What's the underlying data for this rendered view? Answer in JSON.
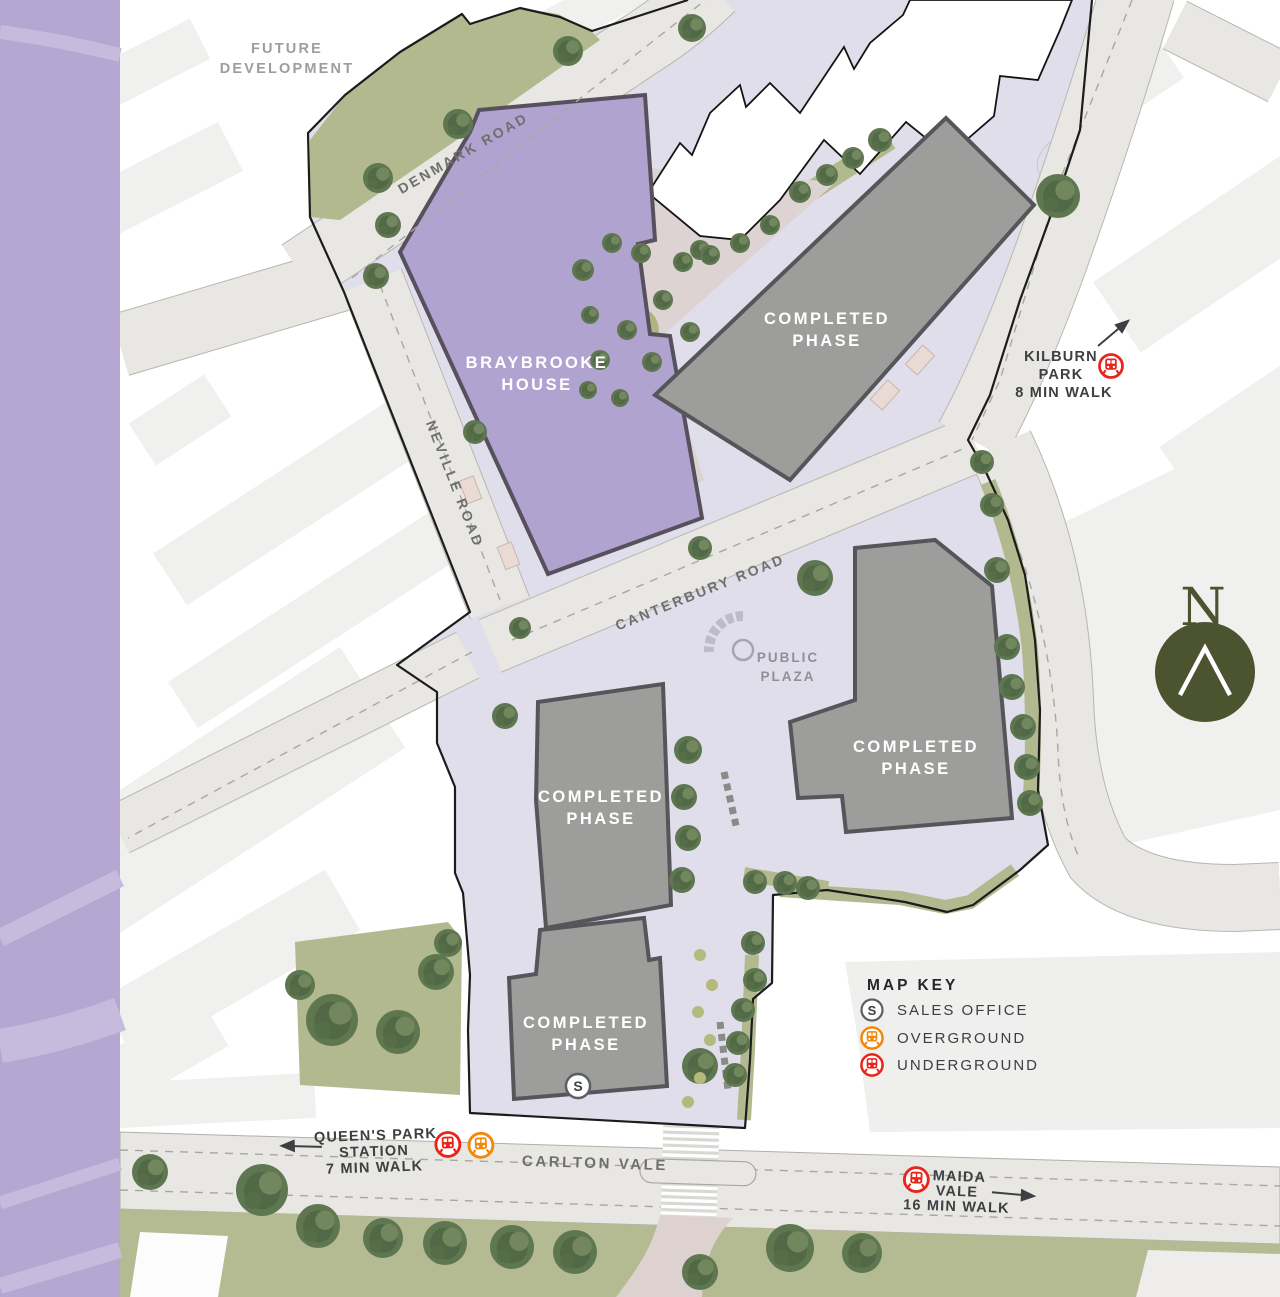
{
  "page": {
    "title": "Development Site Plan"
  },
  "areas": {
    "future_development": {
      "line1": "FUTURE",
      "line2": "DEVELOPMENT"
    },
    "braybrooke": {
      "line1": "BRAYBROOKE",
      "line2": "HOUSE"
    },
    "completed_phase": {
      "line1": "COMPLETED",
      "line2": "PHASE"
    },
    "public_plaza": {
      "line1": "PUBLIC",
      "line2": "PLAZA"
    }
  },
  "roads": {
    "denmark": "DENMARK ROAD",
    "neville": "NEVILLE ROAD",
    "canterbury": "CANTERBURY ROAD",
    "carlton_vale": "CARLTON VALE"
  },
  "stations": {
    "kilburn_park": {
      "line1": "KILBURN",
      "line2": "PARK",
      "line3": "8 MIN WALK"
    },
    "queens_park": {
      "line1": "QUEEN'S PARK",
      "line2": "STATION",
      "line3": "7 MIN WALK"
    },
    "maida_vale": {
      "line1": "MAIDA",
      "line2": "VALE",
      "line3": "16 MIN WALK"
    }
  },
  "map_key": {
    "title": "MAP KEY",
    "sales_office": "SALES OFFICE",
    "overground": "OVERGROUND",
    "underground": "UNDERGROUND",
    "sales_symbol": "S"
  },
  "markers": {
    "sales_office_map": "S"
  },
  "compass": {
    "north": "N"
  },
  "colors": {
    "underground": "#e8251b",
    "overground": "#f2880b",
    "sales_ring": "#5b6065",
    "purple_band": "#b5a7d2",
    "braybrooke_fill": "#b1a3d0",
    "completed_fill": "#9d9d9b",
    "green": "#b4ba92",
    "lavender": "#e1deec",
    "compass": "#4c532f"
  }
}
